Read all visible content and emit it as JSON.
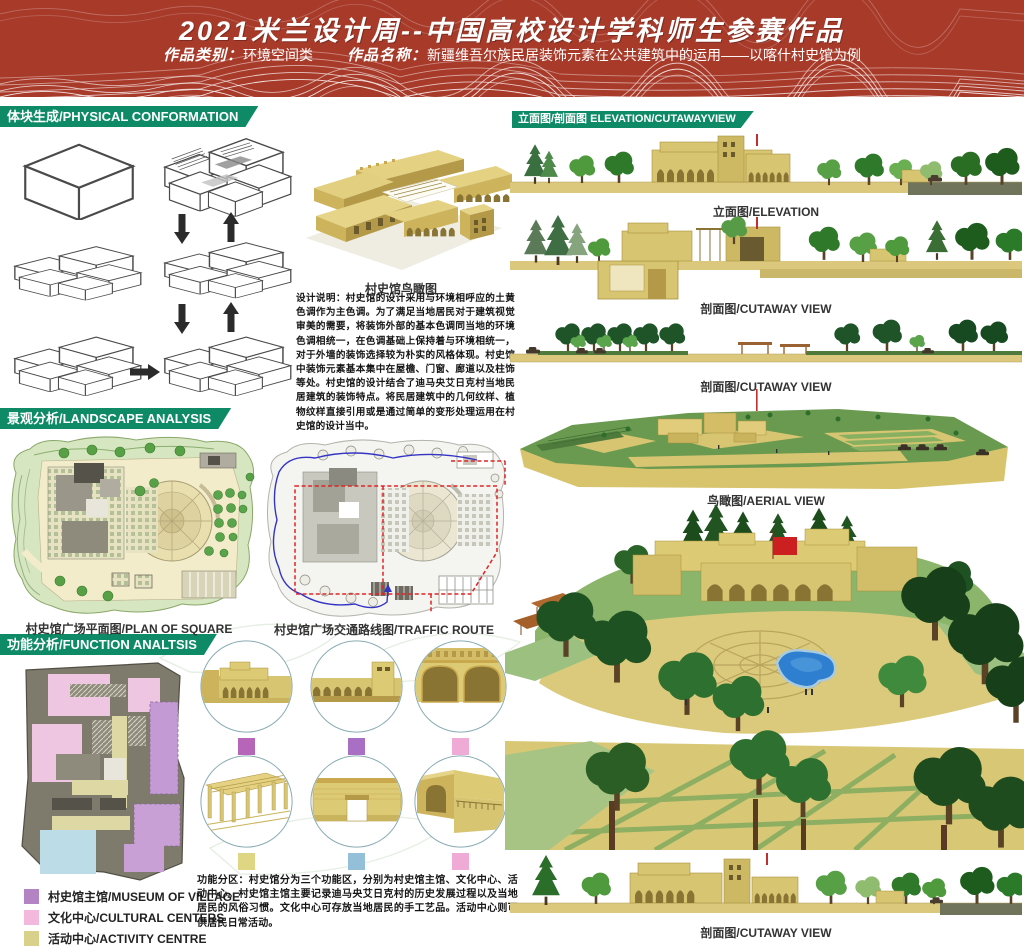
{
  "header": {
    "title": "2021米兰设计周--中国高校设计学科师生参赛作品",
    "category_label": "作品类别：",
    "category_value": "环境空间类",
    "work_label": "作品名称：",
    "work_value": "新疆维吾尔族民居装饰元素在公共建筑中的运用——以喀什村史馆为例"
  },
  "sections": {
    "physical": "体块生成/PHYSICAL CONFORMATION",
    "landscape": "景观分析/LANDSCAPE ANALYSIS",
    "function": "功能分析/FUNCTION ANALTSIS",
    "elevation": "立面图/剖面图 ELEVATION/CUTAWAYVIEW"
  },
  "captions": {
    "museum_aerial": "村史馆鸟瞰图",
    "plan_square": "村史馆广场平面图/PLAN OF SQUARE",
    "traffic": "村史馆广场交通路线图/TRAFFIC ROUTE",
    "elevation": "立面图/ELEVATION",
    "cutaway1": "剖面图/CUTAWAY VIEW",
    "cutaway2": "剖面图/CUTAWAY VIEW",
    "aerial": "鸟瞰图/AERIAL VIEW",
    "cutaway3": "剖面图/CUTAWAY VIEW"
  },
  "notes": {
    "design": "设计说明：村史馆的设计采用与环境相呼应的土黄色调作为主色调。为了满足当地居民对于建筑视觉审美的需要，将装饰外部的基本色调同当地的环境色调相统一，在色调基础上保持着与环境相统一，对于外墙的装饰选择较为朴实的风格体现。村史馆中装饰元素基本集中在屋檐、门窗、廊道以及柱饰等处。村史馆的设计结合了迪马央艾日克村当地民居建筑的装饰特点。将民居建筑中的几何纹样、植物纹样直接引用或是通过简单的变形处理运用在村史馆的设计当中。",
    "function": "功能分区：村史馆分为三个功能区，分别为村史馆主馆、文化中心、活动中心。村史馆主馆主要记录迪马央艾日克村的历史发展过程以及当地居民的风俗习惯。文化中心可存放当地居民的手工艺品。活动中心则可供居民日常活动。"
  },
  "legend": {
    "items": [
      {
        "label": "村史馆主馆/MUSEUM OF VILLAGE",
        "color": "#b383c3"
      },
      {
        "label": "文化中心/CULTURAL CENTERS",
        "color": "#f2b9dc"
      },
      {
        "label": "活动中心/ACTIVITY CENTRE",
        "color": "#d9d08a"
      }
    ]
  },
  "detail_markers": {
    "m1": "#b765b9",
    "m2": "#a96fc4",
    "m3": "#efaad6",
    "m4": "#ded683",
    "m5": "#93bfd9",
    "m6": "#efaad6"
  },
  "colors": {
    "header_bg": "#a83a2a",
    "banner_bg": "#0e8a66",
    "building_tan": "#d8c572",
    "ground_tan": "#dcc87c",
    "pool_blue": "#2f7fd0",
    "flag_red": "#cc2020"
  }
}
